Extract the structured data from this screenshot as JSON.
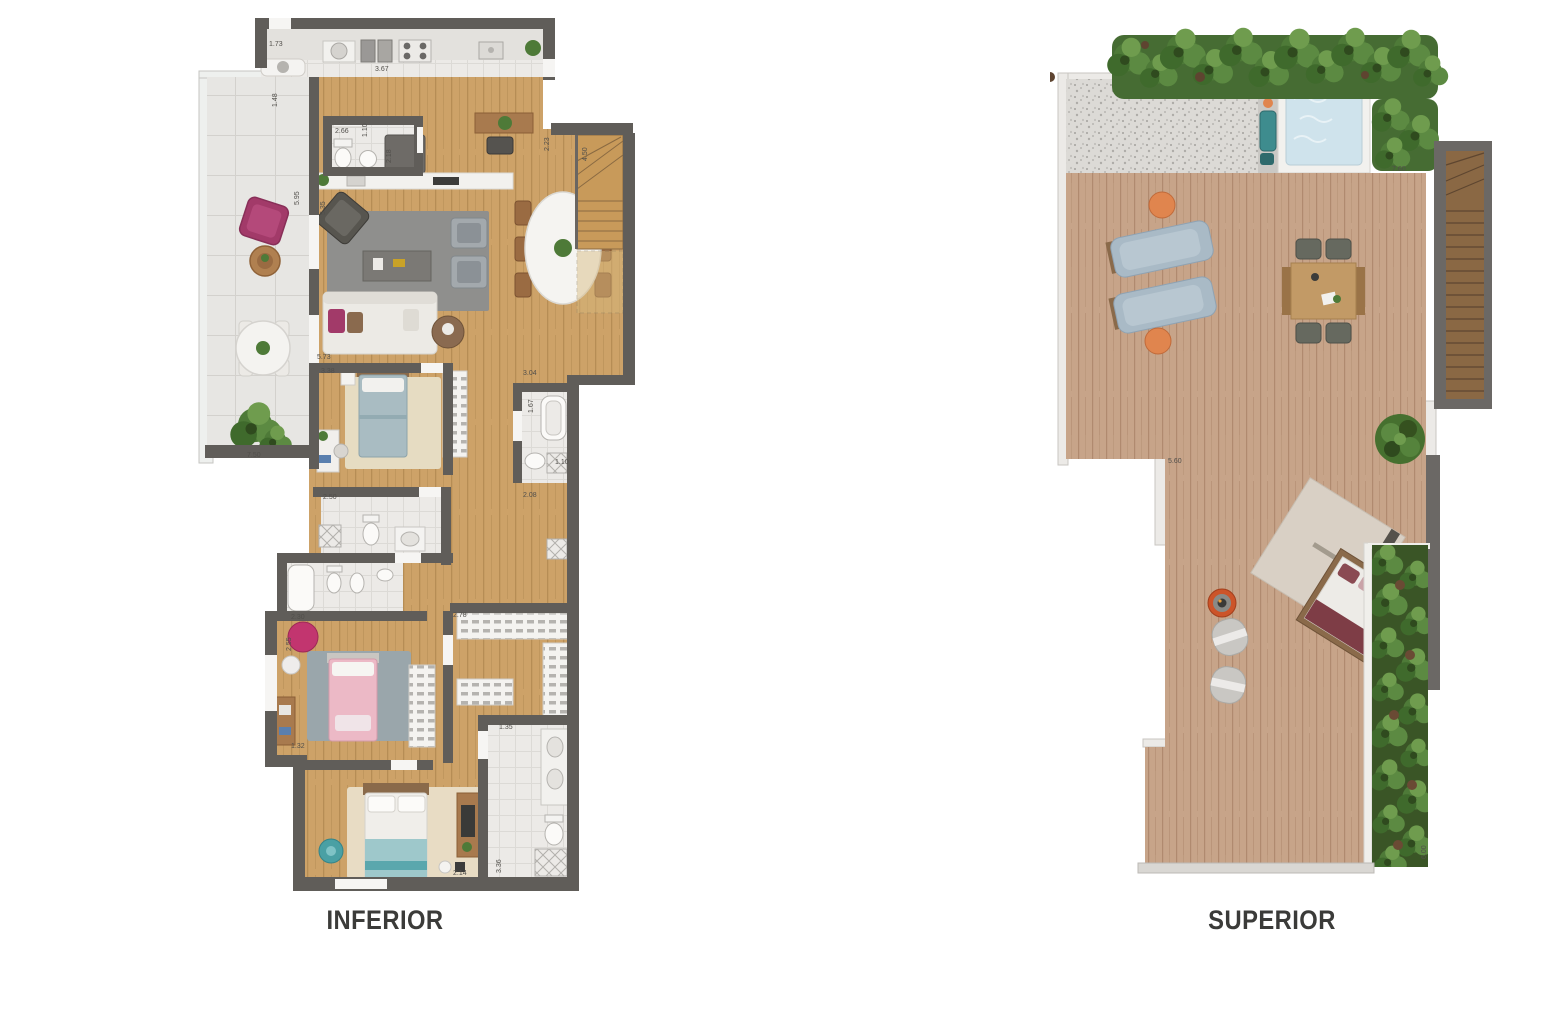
{
  "page": {
    "background_color": "#ffffff",
    "description": "duplex apartment floor plans, lower and upper level"
  },
  "plans": {
    "inferior": {
      "title": "INFERIOR",
      "type": "floor-plan-lower-level",
      "measurements": [
        "1.73",
        "3.67",
        "1.48",
        "2.66",
        "1.10",
        "2.18",
        "5.95",
        "5.35",
        "2.23",
        "4.50",
        "5.73",
        "3.38",
        "3.04",
        "1.67",
        "1.10",
        "2.08",
        "2.50",
        "2.30",
        "2.78",
        "2.55",
        "1.32",
        "1.35",
        "3.36",
        "2.14",
        "7.50"
      ]
    },
    "superior": {
      "title": "SUPERIOR",
      "type": "floor-plan-roof-terrace",
      "measurements": [
        "7.60",
        "5.60",
        "6.00"
      ]
    }
  },
  "colors": {
    "wall": "#605d59",
    "wood_floor": "#cda268",
    "deck_floor": "#c7a489",
    "tile_floor": "#e7e6e3",
    "terrace_tile": "#e4e3e0",
    "rug_gray": "#8f8f8d",
    "hedge_green": "#4e7a38",
    "jacuzzi_water": "#cfe3ec",
    "accent_magenta": "#a23a69",
    "accent_orange": "#e0854e",
    "accent_teal": "#4aa0a4",
    "label_text": "#3b3b39"
  }
}
